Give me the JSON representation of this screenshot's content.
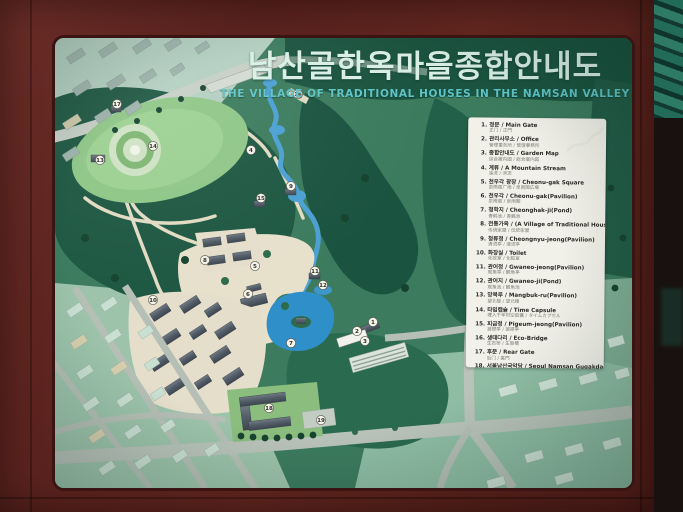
{
  "sign": {
    "title_ko": "남산골한옥마을종합안내도",
    "title_en": "THE VILLAGE OF TRADITIONAL HOUSES IN THE NAMSAN VALLEY"
  },
  "colors": {
    "frame_wood": "#5d2420",
    "forest_dark": "#1d5742",
    "ground_green": "#3c7b5e",
    "water_blue": "#3d97cb",
    "path_beige": "#e5decb",
    "legend_bg": "#f2f1e9",
    "title_ko_color": "#d9efe6",
    "title_en_color": "#5fc4c6",
    "eave_teal": "#226b59"
  },
  "legend": {
    "items": [
      {
        "no": "1.",
        "primary": "정문 / Main Gate",
        "secondary": "正门 / 正門"
      },
      {
        "no": "2.",
        "primary": "관리사무소 / Office",
        "secondary": "管理事务所 / 管理事務所"
      },
      {
        "no": "3.",
        "primary": "종합안내도 / Garden Map",
        "secondary": "综合案内图 / 総合案内図"
      },
      {
        "no": "4.",
        "primary": "계류 / A Mountain Stream",
        "secondary": "溪流 / 渓流"
      },
      {
        "no": "5.",
        "primary": "천우각 광장 / Cheonu-gak Square",
        "secondary": "泉雨阁广场 / 泉雨閣広場"
      },
      {
        "no": "6.",
        "primary": "천우각 / Cheonu-gak(Pavilion)",
        "secondary": "泉雨阁 / 泉雨閣"
      },
      {
        "no": "7.",
        "primary": "청학지 / Cheonghak-ji(Pond)",
        "secondary": "青鹤池 / 青鶴池"
      },
      {
        "no": "8.",
        "primary": "전통가옥 / (A Village of Traditional Houses)",
        "secondary": "传统家屋 / 伝統家屋"
      },
      {
        "no": "9.",
        "primary": "청류정 / Cheongnyu-jeong(Pavilion)",
        "secondary": "清流亭 / 清流亭"
      },
      {
        "no": "10.",
        "primary": "화장실 / Toilet",
        "secondary": "化妆室 / 化粧室"
      },
      {
        "no": "11.",
        "primary": "관어정 / Gwaneo-jeong(Pavilion)",
        "secondary": "观鱼亭 / 観魚亭"
      },
      {
        "no": "12.",
        "primary": "관어지 / Gwaneo-ji(Pond)",
        "secondary": "观鱼池 / 観魚池"
      },
      {
        "no": "13.",
        "primary": "망북루 / Mangbuk-ru(Pavilion)",
        "secondary": "望北楼 / 望北楼"
      },
      {
        "no": "14.",
        "primary": "타임캡슐 / Time Capsule",
        "secondary": "埋入千年时空胶囊 / タイムカプセル"
      },
      {
        "no": "15.",
        "primary": "피금정 / Pigeum-jeong(Pavilion)",
        "secondary": "披襟亭 / 披襟亭"
      },
      {
        "no": "16.",
        "primary": "생태다리 / Eco-Bridge",
        "secondary": "生态桥 / 生態橋"
      },
      {
        "no": "17.",
        "primary": "후문 / Rear Gate",
        "secondary": "后门 / 裏門"
      },
      {
        "no": "18.",
        "primary": "서울남산국악당 / Seoul Namsan Gugakdang",
        "secondary": "首尔南山国乐堂 / ソウル南山国楽堂"
      },
      {
        "no": "19.",
        "primary": "국악당 주차장 / Gugakdang parking place",
        "secondary": "国乐堂停车场 / 国楽堂駐車場"
      }
    ]
  },
  "map_markers": [
    {
      "n": "1",
      "x": 318,
      "y": 284
    },
    {
      "n": "2",
      "x": 302,
      "y": 293
    },
    {
      "n": "3",
      "x": 310,
      "y": 303
    },
    {
      "n": "4",
      "x": 196,
      "y": 112
    },
    {
      "n": "5",
      "x": 200,
      "y": 228
    },
    {
      "n": "6",
      "x": 193,
      "y": 256
    },
    {
      "n": "7",
      "x": 236,
      "y": 305
    },
    {
      "n": "8",
      "x": 150,
      "y": 222
    },
    {
      "n": "9",
      "x": 236,
      "y": 148
    },
    {
      "n": "10",
      "x": 98,
      "y": 262
    },
    {
      "n": "11",
      "x": 260,
      "y": 233
    },
    {
      "n": "12",
      "x": 268,
      "y": 247
    },
    {
      "n": "13",
      "x": 45,
      "y": 122
    },
    {
      "n": "14",
      "x": 98,
      "y": 108
    },
    {
      "n": "15",
      "x": 206,
      "y": 160
    },
    {
      "n": "16",
      "x": 243,
      "y": 56
    },
    {
      "n": "17",
      "x": 62,
      "y": 66
    },
    {
      "n": "18",
      "x": 214,
      "y": 370
    },
    {
      "n": "19",
      "x": 266,
      "y": 382
    }
  ]
}
